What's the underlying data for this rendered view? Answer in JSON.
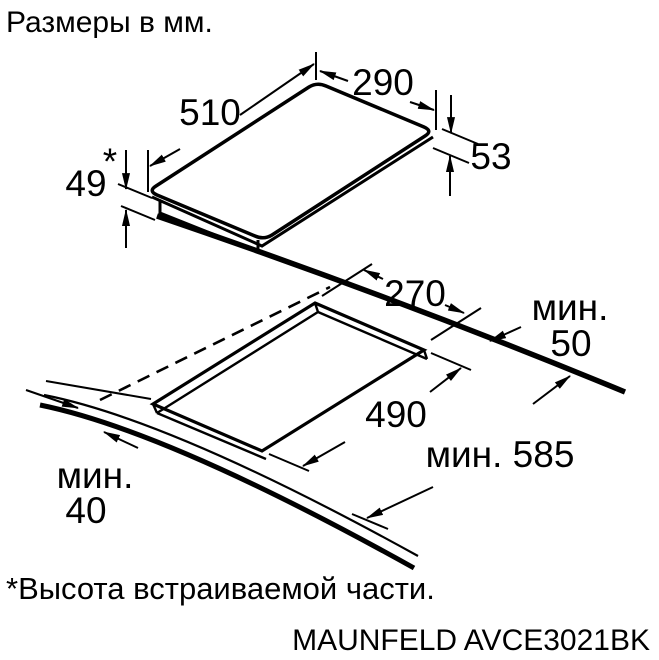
{
  "header": {
    "title": "Размеры в мм."
  },
  "footer": {
    "footnote": "*Высота встраиваемой части.",
    "model": "MAUNFELD AVCE3021BK"
  },
  "hob_top_view": {
    "length_mm": "510",
    "depth_mm": "290",
    "total_height_mm": "53",
    "builtin_height_mm": "49",
    "builtin_height_marker": "*"
  },
  "cutout_view": {
    "cutout_depth_mm": "270",
    "cutout_length_mm": "490",
    "rear_clearance_line1": "мин.",
    "rear_clearance_line2": "50",
    "worktop_depth_label": "мин. 585",
    "front_clearance_line1": "мин.",
    "front_clearance_line2": "40"
  },
  "colors": {
    "ink": "#000000",
    "background": "#ffffff"
  }
}
